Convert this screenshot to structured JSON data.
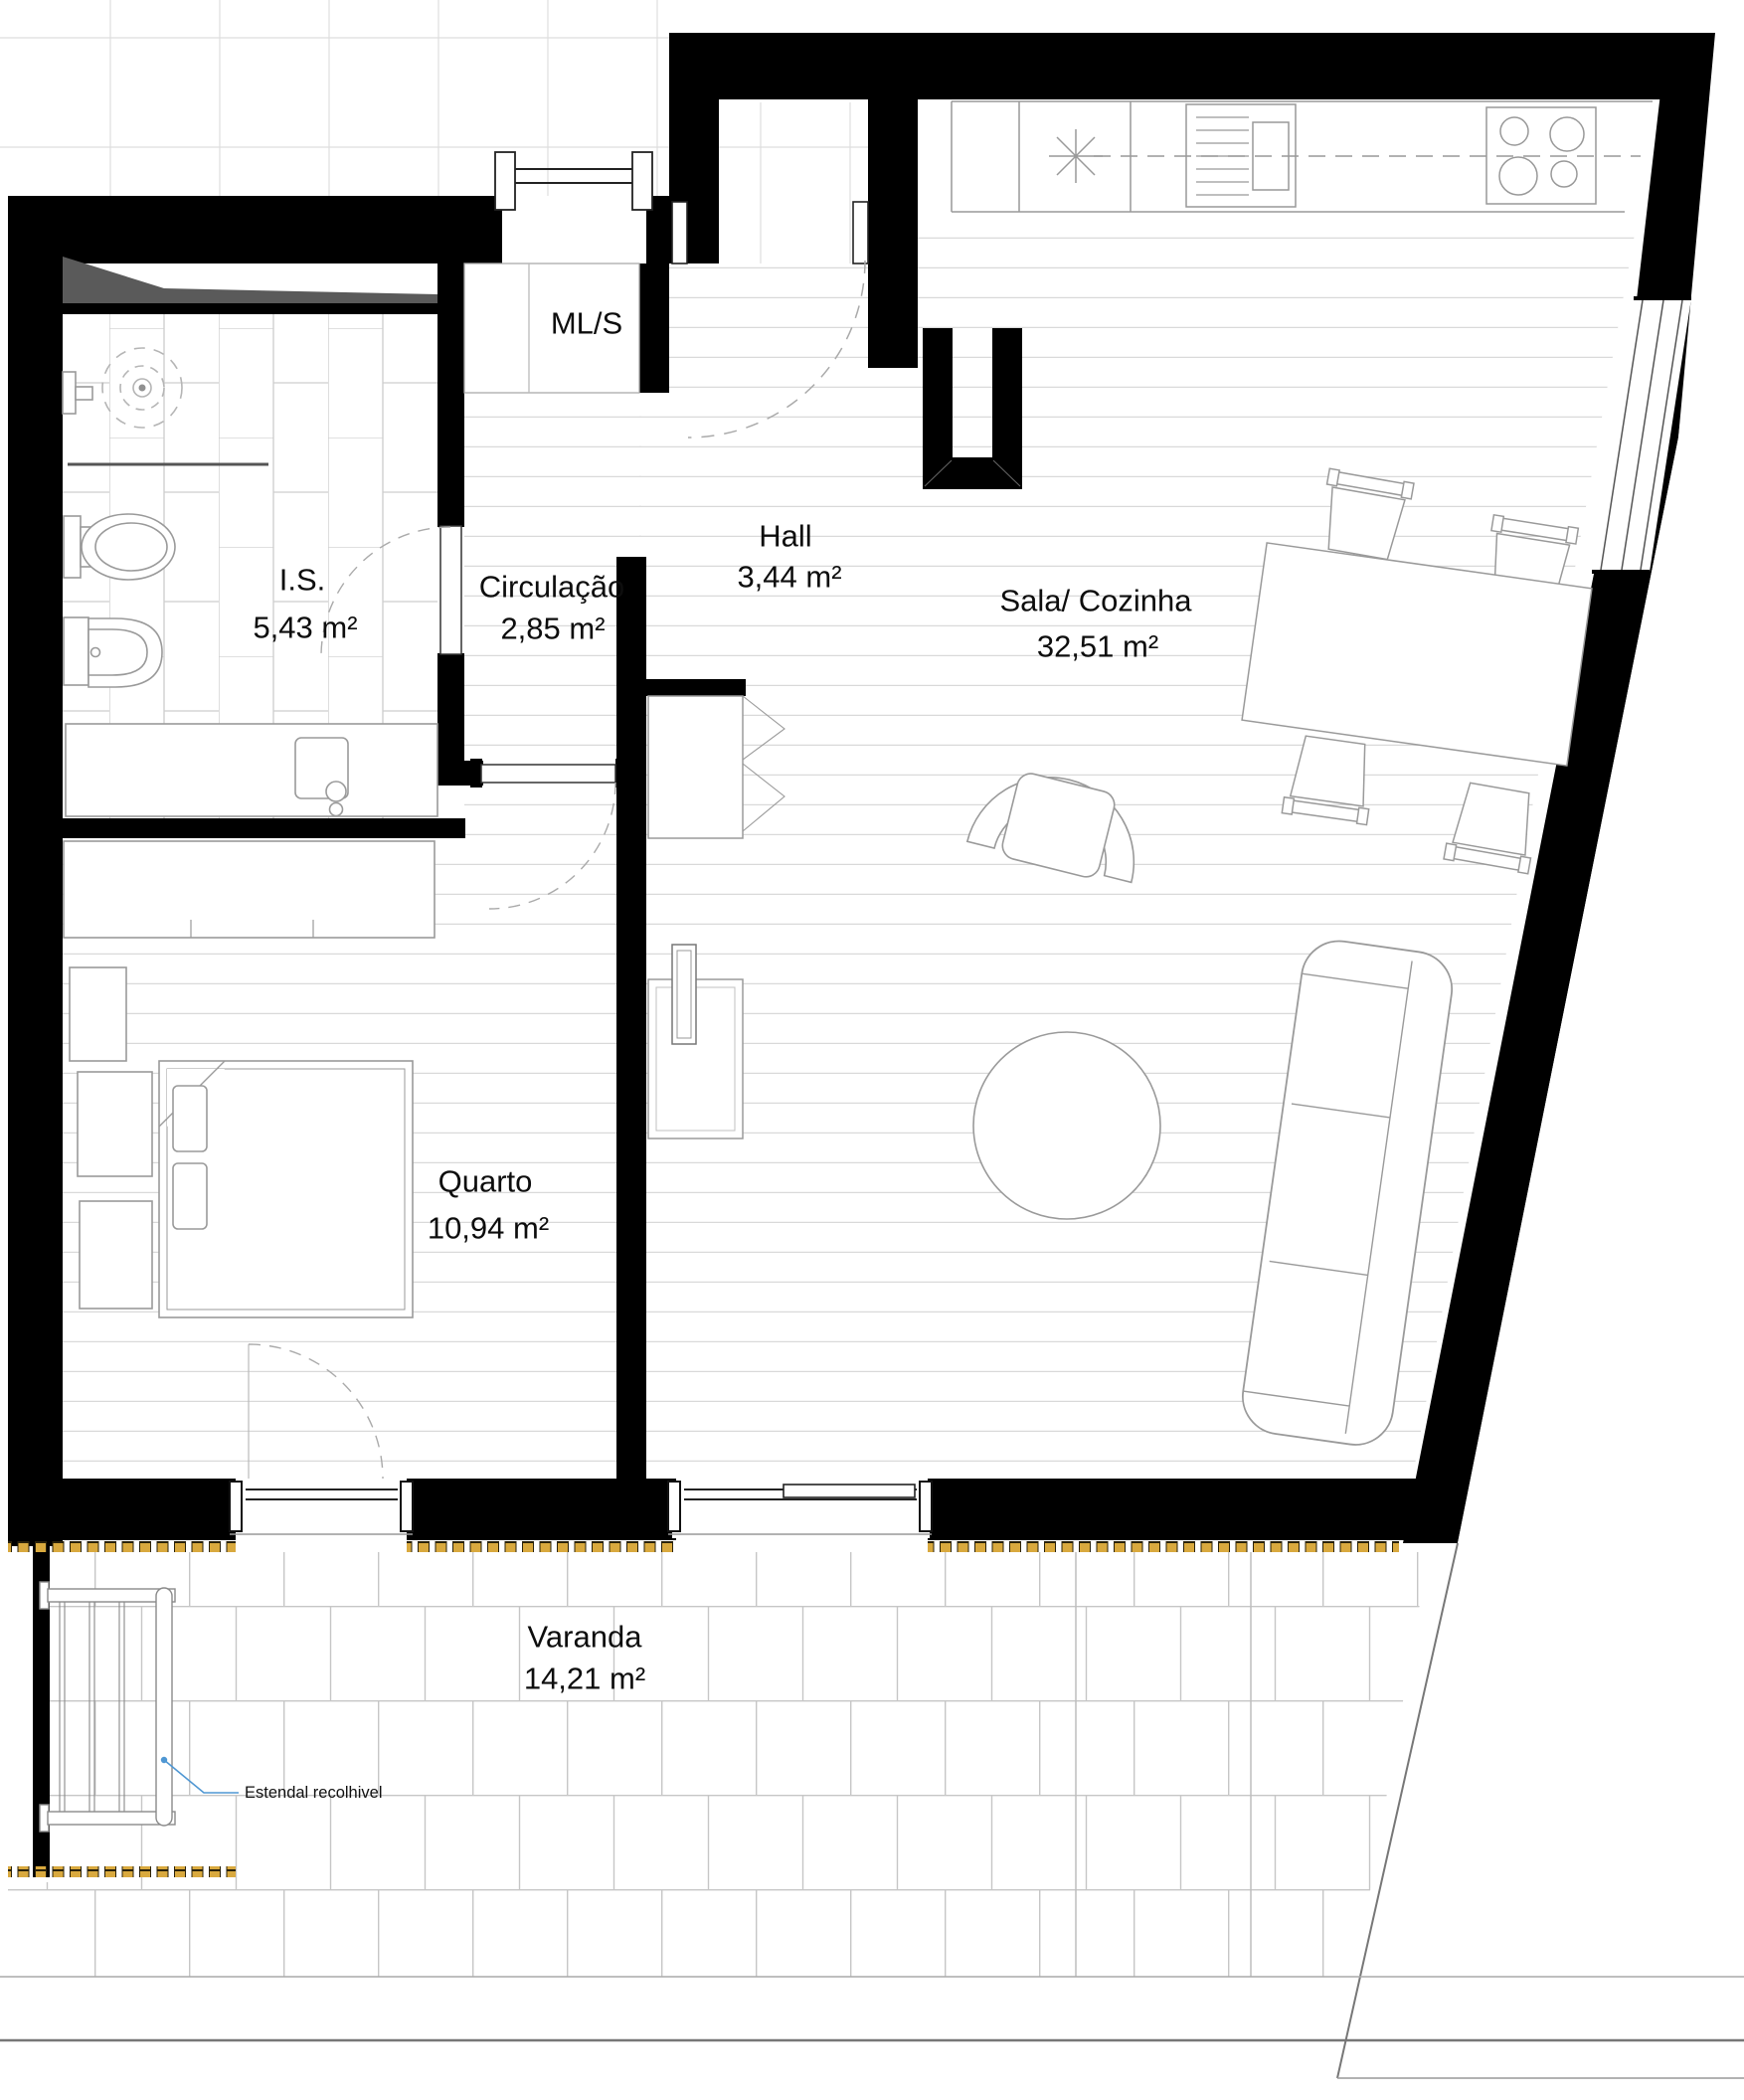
{
  "plan": {
    "rooms": {
      "is": {
        "name": "I.S.",
        "area": "5,43 m²"
      },
      "circulacao": {
        "name": "Circulação",
        "area": "2,85 m²"
      },
      "hall": {
        "name": "Hall",
        "area": "3,44 m²"
      },
      "sala": {
        "name": "Sala/ Cozinha",
        "area": "32,51 m²"
      },
      "quarto": {
        "name": "Quarto",
        "area": "10,94 m²"
      },
      "varanda": {
        "name": "Varanda",
        "area": "14,21 m²"
      }
    },
    "labels": {
      "closet": "ML/S",
      "estendal": "Estendal recolhivel"
    },
    "colors": {
      "wall": "#000000",
      "annotation_blue": "#4f97d3",
      "threshold_gold": "#d9a93e",
      "floor_line": "#d9d9d9"
    }
  }
}
